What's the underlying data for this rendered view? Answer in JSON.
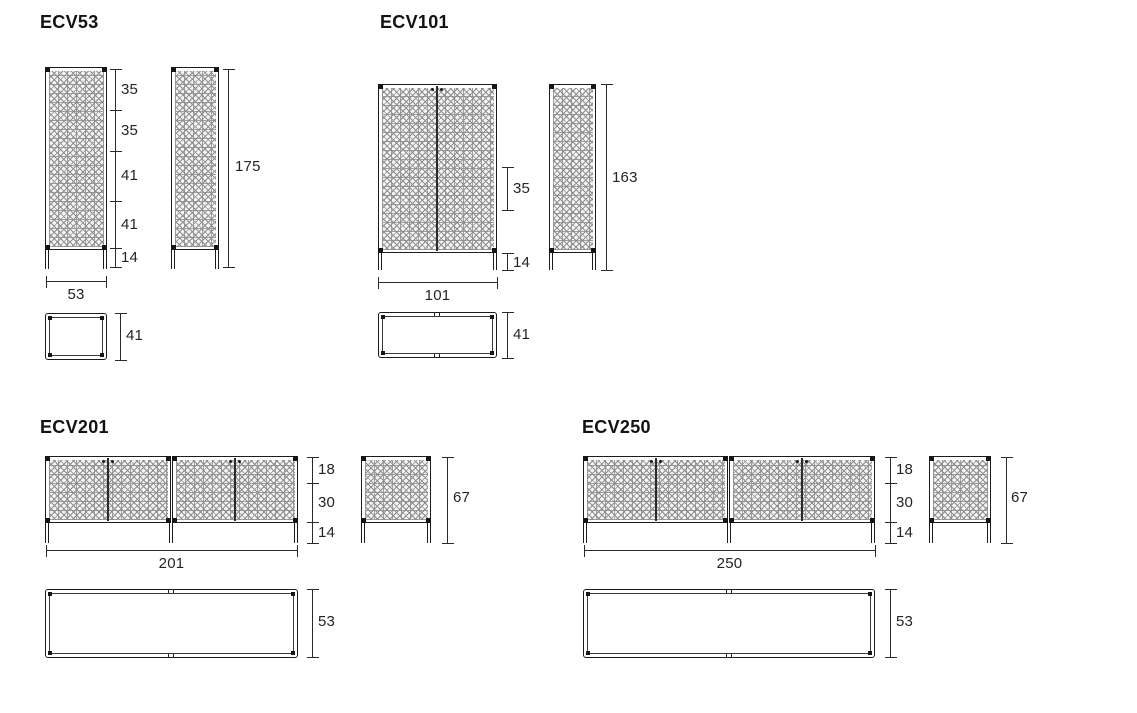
{
  "colors": {
    "background": "#ffffff",
    "line": "#1e1e1e",
    "pattern_gray": "#8f8f8f",
    "text": "#1a1a1a"
  },
  "products": [
    {
      "title": "ECV53",
      "front": {
        "segments": [
          "35",
          "35",
          "41",
          "41",
          "14"
        ],
        "width": "53"
      },
      "side": {
        "height": "175"
      },
      "top": {
        "depth": "41"
      }
    },
    {
      "title": "ECV101",
      "front": {
        "segments": [
          "35",
          "14"
        ],
        "width": "101"
      },
      "side": {
        "height": "163"
      },
      "top": {
        "depth": "41"
      }
    },
    {
      "title": "ECV201",
      "front": {
        "segments": [
          "18",
          "30",
          "14"
        ],
        "width": "201"
      },
      "side": {
        "height": "67"
      },
      "top": {
        "depth": "53"
      }
    },
    {
      "title": "ECV250",
      "front": {
        "segments": [
          "18",
          "30",
          "14"
        ],
        "width": "250"
      },
      "side": {
        "height": "67"
      },
      "top": {
        "depth": "53"
      }
    }
  ]
}
